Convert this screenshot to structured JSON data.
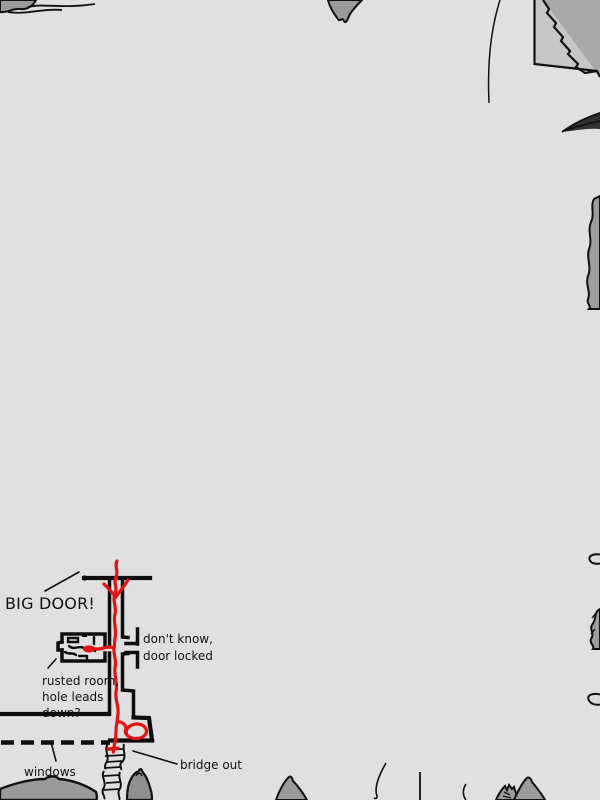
{
  "map": {
    "colors": {
      "background": "#e0e0e0",
      "ink": "#111111",
      "route": "#e51414",
      "rock": "#9a9a9a",
      "rock_dark": "#a8a8a8",
      "rock_light": "#c6c6c6"
    },
    "annotations": {
      "big_door": "BIG DOOR!",
      "door_locked": [
        "don't know,",
        "door locked"
      ],
      "rusted_room": [
        "rusted room,",
        "hole leads",
        "down?"
      ],
      "windows": "windows",
      "bridge_out": "bridge out"
    }
  }
}
